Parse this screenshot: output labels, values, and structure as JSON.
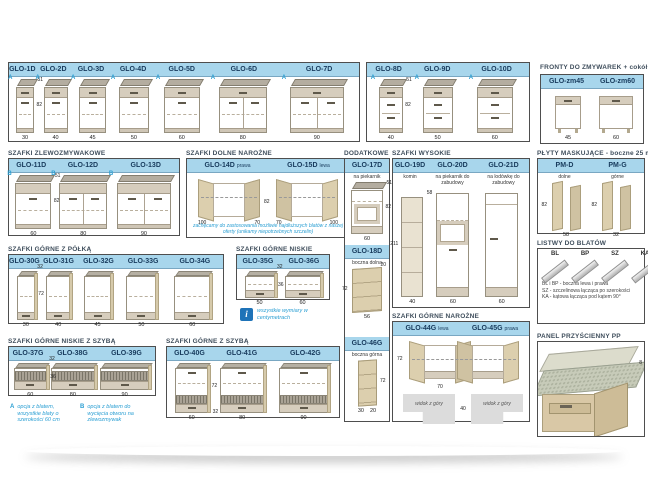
{
  "palette": {
    "header_bg": "#a8d6ec",
    "header_text": "#173a5c",
    "accent_blue": "#2b9fd3",
    "title_text": "#3f4e5c",
    "box_border": "#4e4e4e",
    "wood": "#d9cdae",
    "counter": "#b4ada0"
  },
  "footnotes": {
    "a_marker": "A",
    "a_text": "opcja z blatem, wszystkie blaty o szerokości 60 cm",
    "b_marker": "B",
    "b_text": "opcja z blatem do wycięcia otworu na zlewozmywak",
    "info": "wszystkie wymiary w centymetrach"
  },
  "sections": {
    "base_a": {
      "items": [
        {
          "code": "GLO-1D",
          "marker": "A",
          "w": 30,
          "dim_top": "51",
          "dim_side": "82",
          "variant": "d1"
        },
        {
          "code": "GLO-2D",
          "marker": "A",
          "w": 40,
          "variant": "d1"
        },
        {
          "code": "GLO-3D",
          "marker": "A",
          "w": 45,
          "variant": "d1"
        },
        {
          "code": "GLO-4D",
          "marker": "A",
          "w": 50,
          "variant": "d1"
        },
        {
          "code": "GLO-5D",
          "marker": "A",
          "w": 60,
          "variant": "d1"
        },
        {
          "code": "GLO-6D",
          "marker": "A",
          "w": 80,
          "variant": "d2"
        },
        {
          "code": "GLO-7D",
          "marker": "A",
          "w": 90,
          "variant": "d2"
        }
      ]
    },
    "base_b": {
      "items": [
        {
          "code": "GLO-8D",
          "marker": "A",
          "w": 40,
          "dim_top": "51",
          "dim_side": "82",
          "variant": "drw"
        },
        {
          "code": "GLO-9D",
          "marker": "A",
          "w": 50,
          "variant": "drw"
        },
        {
          "code": "GLO-10D",
          "marker": "A",
          "w": 60,
          "variant": "drw"
        }
      ]
    },
    "fronty": {
      "title": "FRONTY DO ZMYWAREK + cokół",
      "items": [
        {
          "code": "GLO-zm45",
          "w": "45"
        },
        {
          "code": "GLO-zm60",
          "w": "60"
        }
      ]
    },
    "sink": {
      "title": "SZAFKI ZLEWOZMYWAKOWE",
      "items": [
        {
          "code": "GLO-11D",
          "marker": "B",
          "w": 60,
          "dim_top": "51",
          "dim_side": "82",
          "variant": "sink1"
        },
        {
          "code": "GLO-12D",
          "marker": "B",
          "w": 80,
          "variant": "sink2"
        },
        {
          "code": "GLO-13D",
          "marker": "B",
          "w": 90,
          "variant": "sink2"
        }
      ]
    },
    "corner_d": {
      "title": "SZAFKI DOLNE NAROŻNE",
      "dim_mid": "82",
      "note": "zachęcamy do zastosowania możliwie najdłuższych blatów z naszej oferty (unikamy niepotrzebnych szczelin)",
      "items": [
        {
          "code": "GLO-14D",
          "sub": "prawa",
          "dim_l": "100",
          "dim_r": "70"
        },
        {
          "code": "GLO-15D",
          "sub": "lewa",
          "dim_l": "70",
          "dim_r": "100"
        }
      ]
    },
    "dodatkowe": {
      "title": "DODATKOWE",
      "items": [
        {
          "code": "GLO-17D",
          "sub": "na piekarnik",
          "dim_top": "51",
          "dim_side": "82",
          "wlabel": "60"
        },
        {
          "code": "GLO-18D",
          "sub": "boczna dolna",
          "dim_top": "20",
          "dim_side": "72",
          "wlabel": "56"
        },
        {
          "code": "GLO-46G",
          "sub": "boczna górna",
          "dim_side": "72",
          "wlabel": "30",
          "wlabel2": "20"
        }
      ]
    },
    "wysokie": {
      "title": "SZAFKI WYSOKIE",
      "items": [
        {
          "code": "GLO-19D",
          "sub": "komin",
          "w": 40,
          "dim_top": "58",
          "dim_side": "211",
          "variant": "komin"
        },
        {
          "code": "GLO-20D",
          "sub": "na piekarnik do zabudowy",
          "w": 60,
          "variant": "piek"
        },
        {
          "code": "GLO-21D",
          "sub": "na lodówkę do zabudowy",
          "w": 60,
          "variant": "lodow"
        }
      ]
    },
    "plyty": {
      "title": "PŁYTY MASKUJĄCE - boczne 25 mm",
      "items": [
        {
          "code": "PM-D",
          "sub": "dolne",
          "dim_side": "82",
          "wlabel": "58"
        },
        {
          "code": "PM-G",
          "sub": "górne",
          "dim_side": "82",
          "wlabel": "32"
        }
      ]
    },
    "listwy": {
      "title": "LISTWY DO BLATÓW",
      "labels": [
        "BL",
        "BP",
        "SZ",
        "KA"
      ],
      "legend": [
        "BL i BP - boczna lewa i prawa",
        "SZ - szczelinowa łącząca po szerokości",
        "KA - kątowa łącząca pod kątem 90°"
      ]
    },
    "panel_pp": {
      "title": "PANEL PRZYŚCIENNY PP",
      "dim": "8"
    },
    "polka": {
      "title": "SZAFKI GÓRNE Z PÓŁKĄ",
      "items": [
        {
          "code": "GLO-30G",
          "w": 30,
          "dim_top": "32",
          "dim_side": "72",
          "variant": "shelf"
        },
        {
          "code": "GLO-31G",
          "w": 40,
          "variant": "shelf"
        },
        {
          "code": "GLO-32G",
          "w": 45,
          "variant": "shelf"
        },
        {
          "code": "GLO-33G",
          "w": 50,
          "variant": "shelf"
        },
        {
          "code": "GLO-34G",
          "w": 60,
          "variant": "shelf"
        }
      ]
    },
    "niskie": {
      "title": "SZAFKI GÓRNE NISKIE",
      "items": [
        {
          "code": "GLO-35G",
          "w": 50,
          "dim_top": "32",
          "dim_side": "36",
          "variant": "low"
        },
        {
          "code": "GLO-36G",
          "w": 60,
          "variant": "low"
        }
      ]
    },
    "niskie_szyba": {
      "title": "SZAFKI GÓRNE NISKIE Z SZYBĄ",
      "items": [
        {
          "code": "GLO-37G",
          "w": 60,
          "dim_top": "32",
          "dim_side": "36",
          "variant": "lowglass"
        },
        {
          "code": "GLO-38G",
          "w": 80,
          "variant": "lowglass"
        },
        {
          "code": "GLO-39G",
          "w": 90,
          "variant": "lowglass"
        }
      ]
    },
    "gorne_szyba": {
      "title": "SZAFKI GÓRNE Z SZYBĄ",
      "items": [
        {
          "code": "GLO-40G",
          "w": 60,
          "dim_side": "72",
          "dim_b": "32",
          "variant": "glass"
        },
        {
          "code": "GLO-41G",
          "w": 80,
          "variant": "glass"
        },
        {
          "code": "GLO-42G",
          "w": 90,
          "variant": "glass"
        }
      ]
    },
    "narozne_g": {
      "title": "SZAFKI GÓRNE NAROŻNE",
      "dim_side": "72",
      "dim_w": "70",
      "dim_d": "40",
      "view_label": "widok z góry",
      "items": [
        {
          "code": "GLO-44G",
          "sub": "lewa"
        },
        {
          "code": "GLO-45G",
          "sub": "prawa"
        }
      ]
    }
  }
}
